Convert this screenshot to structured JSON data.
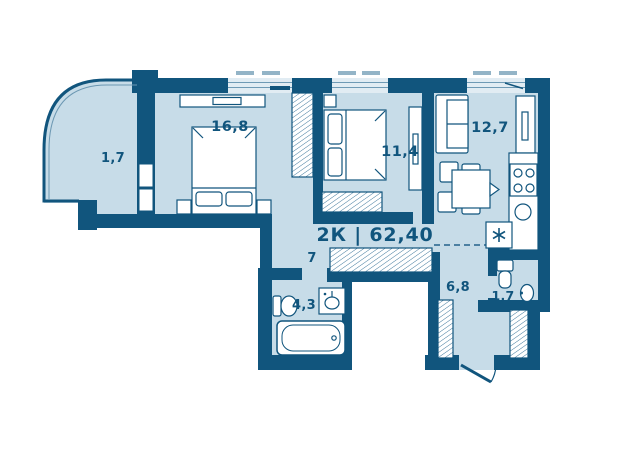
{
  "title": {
    "text": "2К | 62,40"
  },
  "rooms": [
    {
      "name": "balcony",
      "area": "1,7"
    },
    {
      "name": "bedroom-1",
      "area": "16,8"
    },
    {
      "name": "bedroom-2",
      "area": "11,4"
    },
    {
      "name": "kitchen-living-room",
      "area": "12,7"
    },
    {
      "name": "hallway",
      "area": "7"
    },
    {
      "name": "bathroom",
      "area": "4,3"
    },
    {
      "name": "corridor",
      "area": "6,8"
    },
    {
      "name": "wc",
      "area": "1,7"
    }
  ],
  "icons": {
    "appliance_marker": "asterisk-star",
    "furniture": [
      "bed",
      "wardrobe-hatched",
      "sofa",
      "dining-table",
      "stove",
      "kitchen-sink",
      "fridge",
      "bathtub",
      "toilet",
      "washbasin",
      "tv-console",
      "entrance-door",
      "window"
    ]
  },
  "colors": {
    "wall": "#11557d",
    "floor": "#c7dce8",
    "window_glass": "#e1ecf3",
    "furniture_fill": "#ffffff",
    "vent_dash": "#93b4c7"
  }
}
